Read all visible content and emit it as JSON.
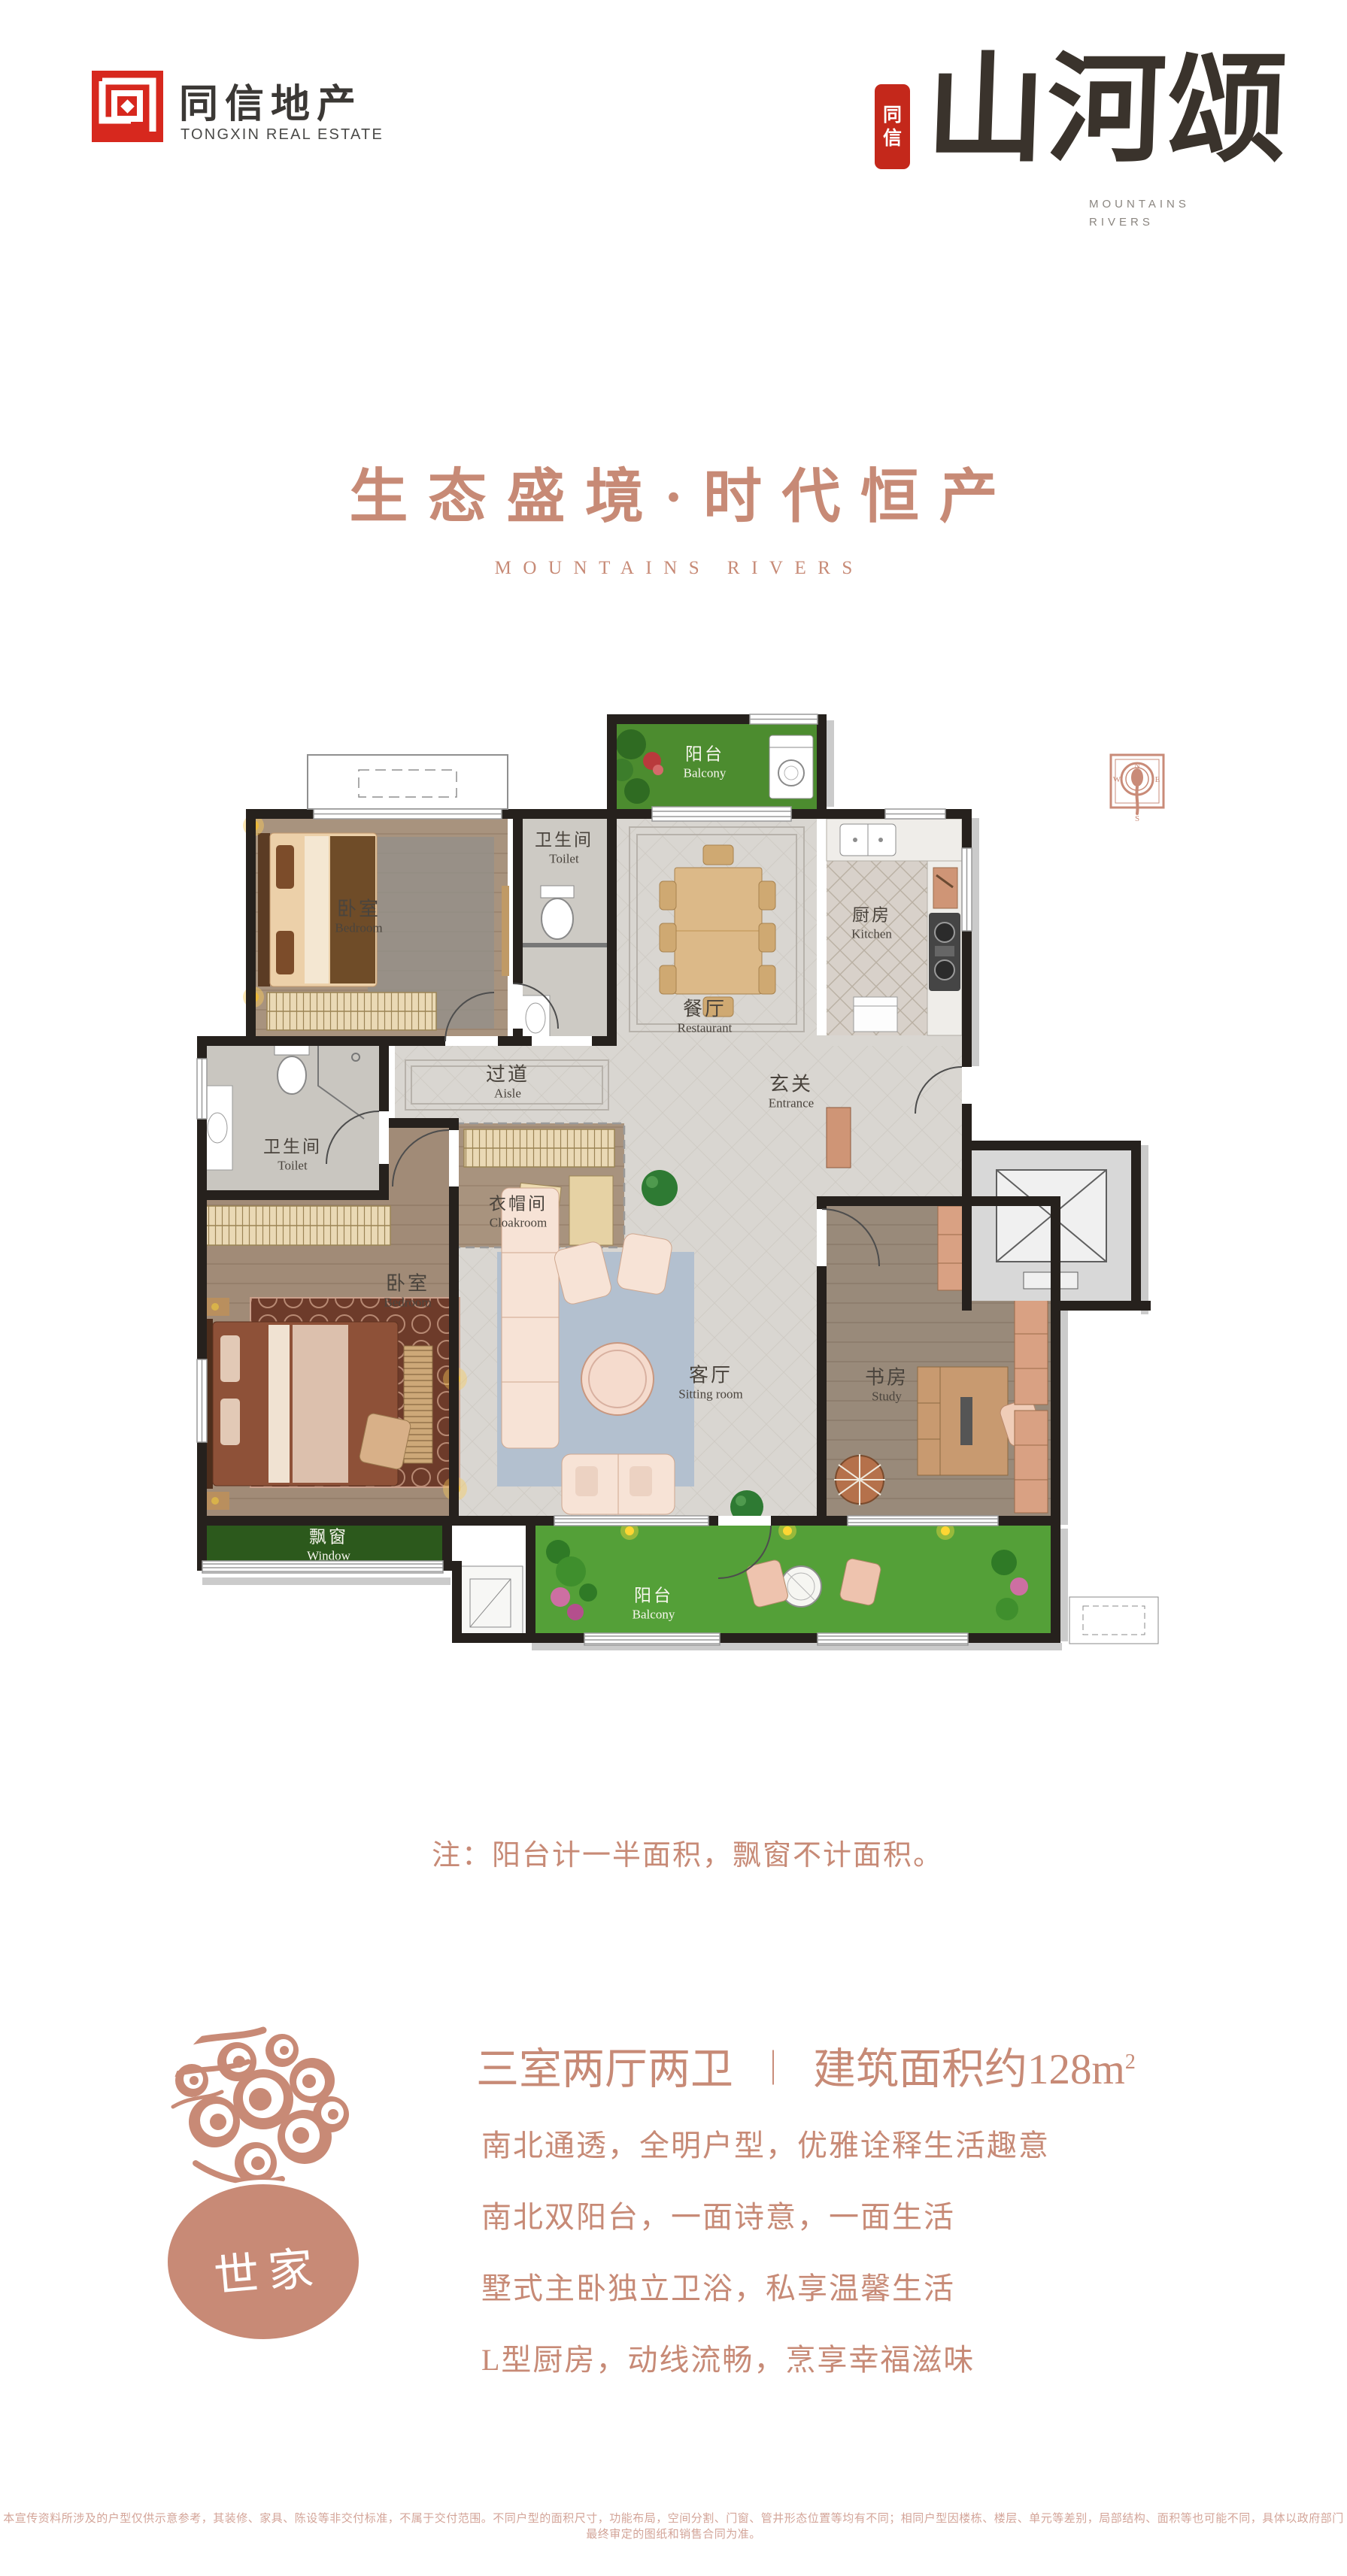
{
  "brand": {
    "logo_mark": "同",
    "name_zh": "同信地产",
    "name_en": "TONGXIN REAL ESTATE"
  },
  "art": {
    "seal_char1": "同",
    "seal_char2": "信",
    "title": "山河颂",
    "sub_line1": "MOUNTAINS",
    "sub_line2": "RIVERS"
  },
  "hero": {
    "title": "生态盛境·时代恒产",
    "subtitle": "MOUNTAINS RIVERS"
  },
  "floorplan": {
    "rooms": [
      {
        "zh": "阳台",
        "en": "Balcony"
      },
      {
        "zh": "卧室",
        "en": "Bedroom"
      },
      {
        "zh": "卫生间",
        "en": "Toilet"
      },
      {
        "zh": "餐厅",
        "en": "Restaurant"
      },
      {
        "zh": "厨房",
        "en": "Kitchen"
      },
      {
        "zh": "过道",
        "en": "Aisle"
      },
      {
        "zh": "玄关",
        "en": "Entrance"
      },
      {
        "zh": "卫生间",
        "en": "Toilet"
      },
      {
        "zh": "衣帽间",
        "en": "Cloakroom"
      },
      {
        "zh": "卧室",
        "en": "Bedroom"
      },
      {
        "zh": "客厅",
        "en": "Sitting room"
      },
      {
        "zh": "书房",
        "en": "Study"
      },
      {
        "zh": "飘窗",
        "en": "Window"
      },
      {
        "zh": "阳台",
        "en": "Balcony"
      }
    ],
    "compass": {
      "n": "N",
      "e": "E",
      "s": "S",
      "w": "W"
    }
  },
  "note": "注：阳台计一半面积，飘窗不计面积。",
  "summary": {
    "badge": "世家",
    "layout": "三室两厅两卫",
    "divider": "｜",
    "area_text": "建筑面积约128m",
    "area_sup": "2",
    "features": [
      "南北通透，全明户型，优雅诠释生活趣意",
      "南北双阳台，一面诗意，一面生活",
      "墅式主卧独立卫浴，私享温馨生活",
      "L型厨房，动线流畅，烹享幸福滋味"
    ]
  },
  "disclaimer": "本宣传资料所涉及的户型仅供示意参考，其装修、家具、陈设等非交付标准，不属于交付范围。不同户型的面积尺寸，功能布局，空间分割、门窗、管井形态位置等均有不同；相同户型因楼栋、楼层、单元等差别，局部结构、面积等也可能不同，具体以政府部门最终审定的图纸和销售合同为准。",
  "colors": {
    "accent": "#c78a76",
    "brand_red": "#d7281e",
    "seal_red": "#c4281b",
    "wall": "#26211d",
    "grass_north": "#4c8c2f",
    "grass_south": "#54a038",
    "bay_green": "#2c591c",
    "marble": "#d9d6d1",
    "wood": "#a8937e"
  }
}
